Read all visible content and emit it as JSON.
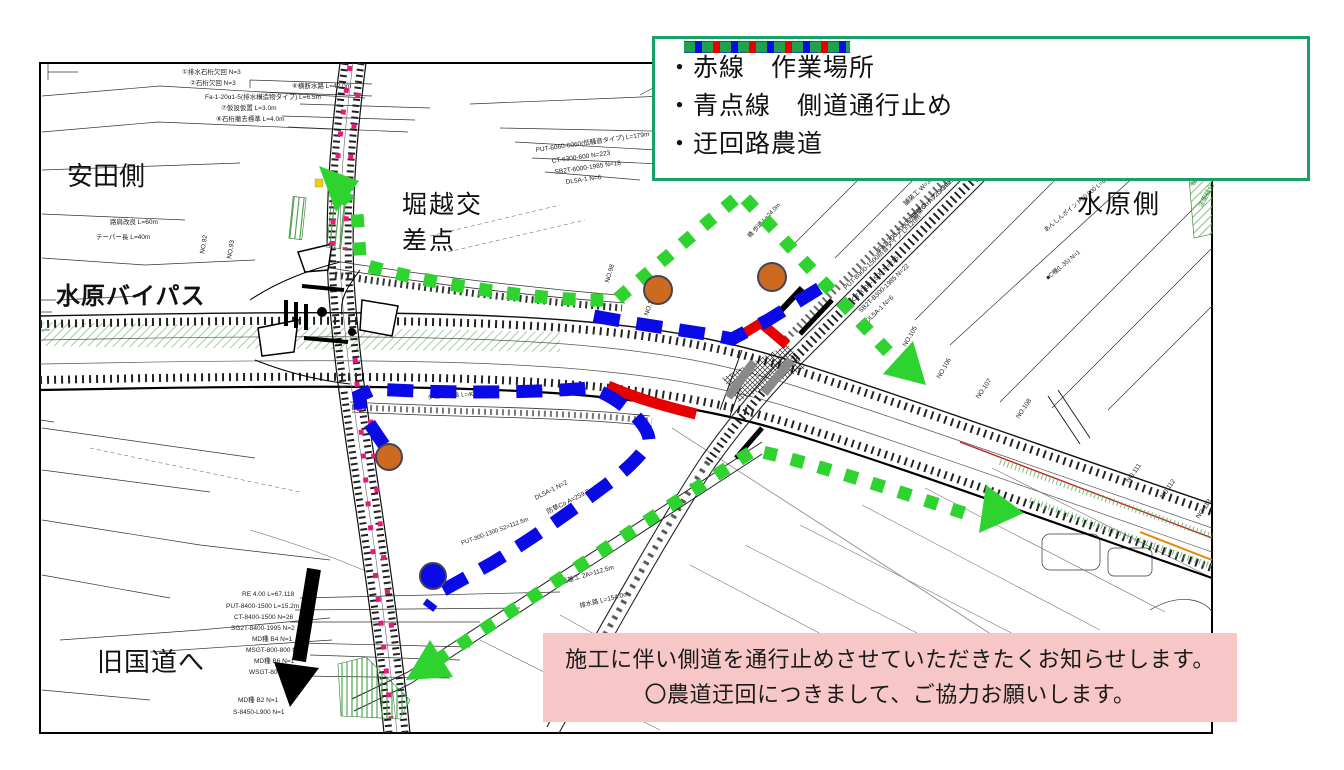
{
  "legend": {
    "border_color": "#18a06a",
    "items": [
      {
        "id": "work-area",
        "swatch": "red-solid",
        "color": "#e60000",
        "label": "・赤線　作業場所"
      },
      {
        "id": "side-road-closed",
        "swatch": "blue-dashed",
        "color": "#0a0ae6",
        "label": "・青点線　側道通行止め"
      },
      {
        "id": "detour-farm-road",
        "swatch": "green-dotted",
        "color": "#1fa24c",
        "label": "・迂回路農道"
      }
    ]
  },
  "map_labels": {
    "yasuda_side": "安田側",
    "suibara_bypass": "水原バイパス",
    "horikoshi_line1": "堀越交",
    "horikoshi_line2": "差点",
    "suibara_side": "水原側",
    "to_old_national_road": "旧国道へ"
  },
  "notice": {
    "background_color": "#f7c6c6",
    "line1": "施工に伴い側道を通行止めさせていただきたくお知らせします。",
    "line2": "〇農道迂回につきまして、ご協力お願いします。"
  },
  "routes": {
    "work_area_color": "#e60000",
    "closed_color": "#0a0ae6",
    "detour_color": "#2fd32f",
    "direction_arrow_color": "#000000"
  },
  "markers": {
    "orange_point_color": "#cc6a1f",
    "blue_point_color": "#0a0ae6",
    "survey_dot_color": "#e8187c",
    "orange_points": 3,
    "blue_points": 1
  },
  "map_annotations": [
    {
      "t": "①排水石桁欠回 N=3",
      "x": 182,
      "y": 74
    },
    {
      "t": "②石桁欠回 N=3",
      "x": 190,
      "y": 85
    },
    {
      "t": "⑥横断水路 L=42.0m",
      "x": 292,
      "y": 88
    },
    {
      "t": "Fa-1-20α1-5(排水構造物タイプ) L=6.5m",
      "x": 205,
      "y": 99
    },
    {
      "t": "⑦仮設仮置 L=3.0m",
      "x": 221,
      "y": 110
    },
    {
      "t": "⑧石桁撤去標準 L=4.0m",
      "x": 216,
      "y": 121
    },
    {
      "t": "路肩改良 L=60m",
      "x": 110,
      "y": 224
    },
    {
      "t": "テーパー長 L=40m",
      "x": 96,
      "y": 239
    },
    {
      "t": "PUT-6060-6060(低騒音タイプ) L=179m",
      "x": 536,
      "y": 152,
      "r": -8
    },
    {
      "t": "CT-6300-600 N=223",
      "x": 552,
      "y": 163,
      "r": -8
    },
    {
      "t": "SB2T-6000-1985 N=18",
      "x": 555,
      "y": 174,
      "r": -8
    },
    {
      "t": "DL5A-1 N=6",
      "x": 566,
      "y": 184,
      "r": -8
    },
    {
      "t": "橋 歩道 L=24.0m",
      "x": 750,
      "y": 238,
      "r": -47,
      "s": 6
    },
    {
      "t": "舗装工 W=3.50 L=123m",
      "x": 906,
      "y": 206,
      "r": -44
    },
    {
      "t": "防草Co A=2.90m2",
      "x": 914,
      "y": 219,
      "r": -44
    },
    {
      "t": "Fa1-300-2000防音壁タイプ L=29m",
      "x": 880,
      "y": 252,
      "r": -44
    },
    {
      "t": "PUT-B900-1500防音タイプ L=120m",
      "x": 846,
      "y": 290,
      "r": -44
    },
    {
      "t": "CT-8700-1500 N=215",
      "x": 854,
      "y": 302,
      "r": -44
    },
    {
      "t": "SB2T-B300-1985 N=22",
      "x": 861,
      "y": 313,
      "r": -44
    },
    {
      "t": "DL5A-1 N=6",
      "x": 868,
      "y": 323,
      "r": -44
    },
    {
      "t": "あんしんポイント50.800 L=6m",
      "x": 1046,
      "y": 232,
      "r": -40,
      "s": 6
    },
    {
      "t": "■C種(L.35) N=1",
      "x": 1048,
      "y": 280,
      "r": -40,
      "s": 6
    },
    {
      "t": "歩道 平縦長 L=40m",
      "x": 428,
      "y": 399,
      "r": -4,
      "s": 6
    },
    {
      "t": "DL5A-1 N=2",
      "x": 536,
      "y": 500,
      "r": -27
    },
    {
      "t": "防草Co A=259.8m2",
      "x": 548,
      "y": 514,
      "r": -27
    },
    {
      "t": "PUT-300-1300 S2=112.5m",
      "x": 462,
      "y": 545,
      "r": -20,
      "s": 6
    },
    {
      "t": "落差工 2A=112.5m",
      "x": 562,
      "y": 584,
      "r": -16
    },
    {
      "t": "排水路 L=154.0m",
      "x": 580,
      "y": 608,
      "r": -14
    },
    {
      "t": "RE 4.00 L=67.118",
      "x": 242,
      "y": 596
    },
    {
      "t": "PUT-8400-1500 L=15.2m",
      "x": 226,
      "y": 608
    },
    {
      "t": "CT-8400-1500 N=26",
      "x": 234,
      "y": 619
    },
    {
      "t": "SG2T-8400-1995 N=2",
      "x": 231,
      "y": 630
    },
    {
      "t": "MD種 B4 N=1",
      "x": 252,
      "y": 641
    },
    {
      "t": "MSGT-800-800 N=1",
      "x": 246,
      "y": 652
    },
    {
      "t": "MD種 B6 N=1",
      "x": 254,
      "y": 663
    },
    {
      "t": "WSGT-800-800 N=1",
      "x": 249,
      "y": 674
    },
    {
      "t": "MD種 B2 N=1",
      "x": 238,
      "y": 702
    },
    {
      "t": "S-8450-L900 N=1",
      "x": 233,
      "y": 714
    },
    {
      "t": "NO.92",
      "x": 204,
      "y": 254,
      "r": -80
    },
    {
      "t": "NO.93",
      "x": 231,
      "y": 259,
      "r": -80
    },
    {
      "t": "NO.98",
      "x": 609,
      "y": 283,
      "r": -74
    },
    {
      "t": "NO.100",
      "x": 648,
      "y": 316,
      "r": -72
    },
    {
      "t": "NO.105",
      "x": 906,
      "y": 347,
      "r": -60
    },
    {
      "t": "NO.106",
      "x": 940,
      "y": 379,
      "r": -60
    },
    {
      "t": "NO.107",
      "x": 979,
      "y": 399,
      "r": -56
    },
    {
      "t": "NO.108",
      "x": 1019,
      "y": 419,
      "r": -56
    },
    {
      "t": "NO.111",
      "x": 1129,
      "y": 483,
      "r": -55
    },
    {
      "t": "NO.112",
      "x": 1163,
      "y": 499,
      "r": -55
    },
    {
      "t": "NO.113",
      "x": 1199,
      "y": 519,
      "r": -55
    },
    {
      "t": "植生工",
      "x": 1194,
      "y": 186,
      "r": -62,
      "c": "#2a8a2a"
    },
    {
      "t": "法面緑化",
      "x": 1202,
      "y": 208,
      "r": -62,
      "c": "#2a8a2a"
    }
  ]
}
